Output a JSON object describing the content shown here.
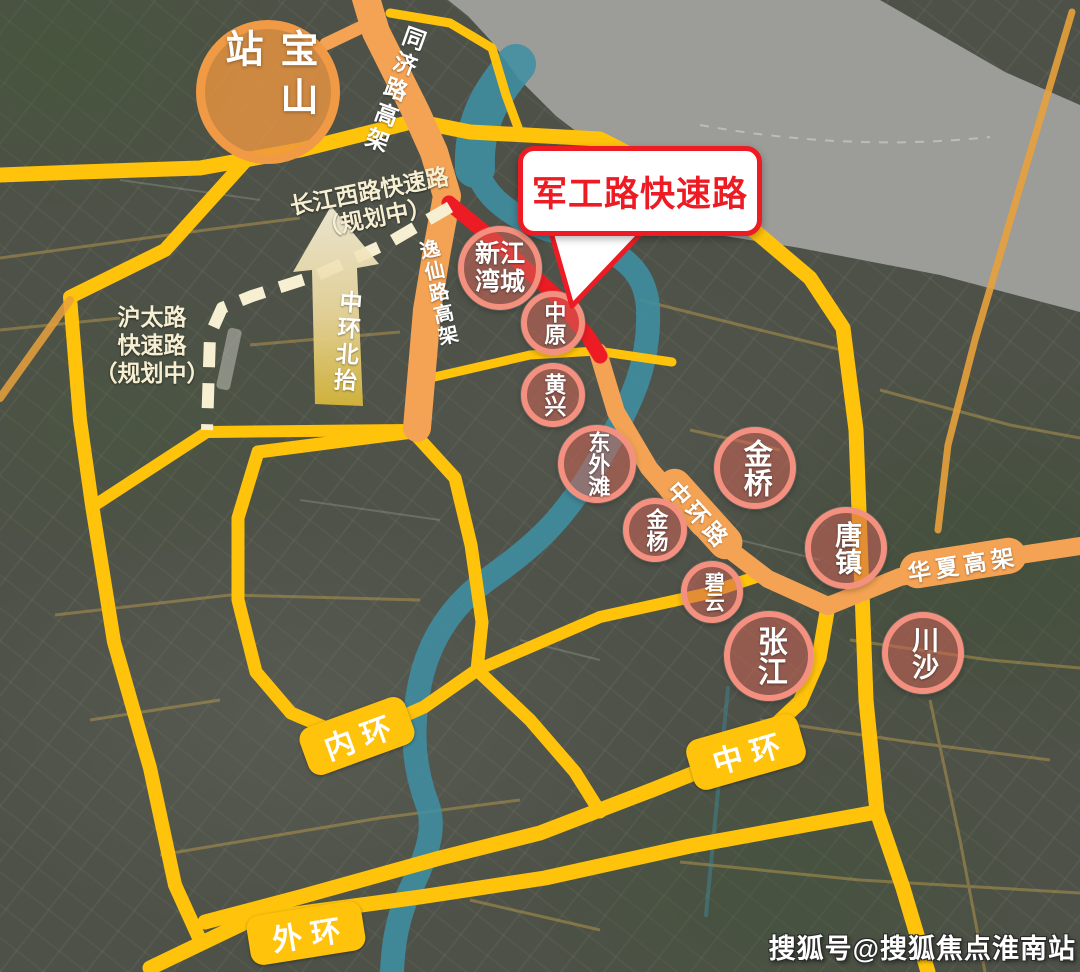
{
  "map": {
    "station": {
      "label": "宝山站"
    },
    "callout": {
      "label": "军工路快速路"
    },
    "arrow": {
      "label": "中环北抬"
    },
    "road_labels": {
      "tongji_elevated": "同济路高架",
      "yixian_elevated": "逸仙路高架",
      "changjiang_west_planned": "长江西路快速路\n（规划中）",
      "hutai_planned": "沪太路\n快速路\n（规划中）",
      "zhonghuan_road": "中环路",
      "huaxia_elevated": "华夏高架"
    },
    "ring_badges": {
      "inner": "内环",
      "middle": "中环",
      "outer": "外环"
    },
    "districts": [
      {
        "id": "xinjiangwancheng",
        "label": "新江\n湾城"
      },
      {
        "id": "zhongyuan",
        "label": "中原"
      },
      {
        "id": "huangxing",
        "label": "黄兴"
      },
      {
        "id": "dongwaitan",
        "label": "东外滩"
      },
      {
        "id": "jinyang",
        "label": "金杨"
      },
      {
        "id": "biyun",
        "label": "碧云"
      },
      {
        "id": "jinqiao",
        "label": "金桥"
      },
      {
        "id": "tangzhen",
        "label": "唐镇"
      },
      {
        "id": "zhangjiang",
        "label": "张江"
      },
      {
        "id": "chuansha",
        "label": "川沙"
      }
    ],
    "watermark": "搜狐号@搜狐焦点淮南站",
    "colors": {
      "ring_road_yellow": "#FFC30B",
      "elevated_orange": "#F4A253",
      "highlight_red": "#ED1C24",
      "district_circle_pink": "#F4907F",
      "planned_road_cream": "#F7EFD2",
      "river_teal": "#3F8FA4",
      "station_orange": "#F09A45"
    }
  }
}
